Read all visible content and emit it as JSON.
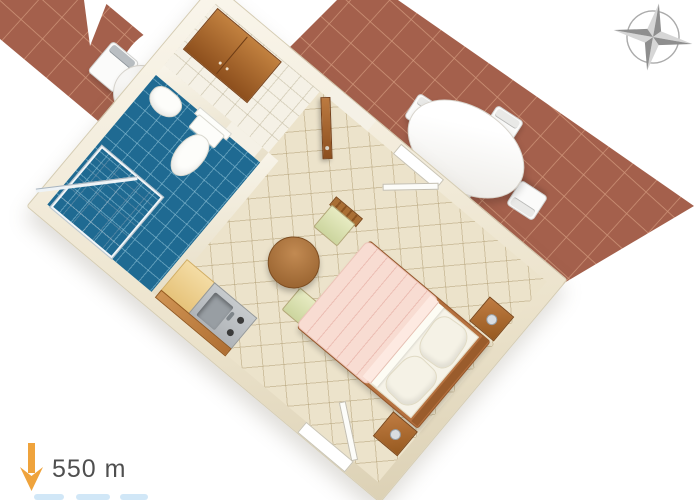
{
  "page": {
    "kind": "3d-floor-plan-render",
    "background": "#ffffff"
  },
  "distance_marker": {
    "label": "550 m",
    "arrow_icon": "down-arrow-icon",
    "arrow_color": "#efa33c",
    "label_color": "#4f4f4f"
  },
  "compass": {
    "icon": "compass-rose-icon",
    "points": 4,
    "color_dark": "#8e8e8e",
    "color_light": "#d6d6d6",
    "ring_color": "#ababab"
  },
  "terraces": {
    "tile_color": "#a4604c",
    "grout_color": "#cf9579",
    "upper_right_terrace": {
      "furniture": [
        "oval-table",
        "terrace-chair",
        "terrace-chair",
        "terrace-chair",
        "terrace-chair"
      ]
    },
    "upper_left_terrace": {
      "furniture": [
        "small-round-table",
        "terrace-chair"
      ]
    }
  },
  "apartment": {
    "wall_color": "#f2ecdd",
    "hallway": {
      "floor_color": "#f5f1e6",
      "furniture": [
        "wardrobe"
      ],
      "openings": [
        "entrance-door"
      ]
    },
    "bathroom": {
      "floor_color": "#1f6a92",
      "fixtures": [
        "shower-cabin",
        "toilet",
        "washbasin"
      ],
      "openings": [
        "bathroom-doorway"
      ]
    },
    "main_room": {
      "floor_color": "#ece3cb",
      "furniture": [
        "kitchenette",
        "sink",
        "hob",
        "dining-table",
        "dining-chair",
        "dining-chair",
        "double-bed",
        "nightstand",
        "nightstand"
      ],
      "openings": [
        "window-top-wall",
        "window-bottom-wall"
      ],
      "bed_colors": {
        "blanket": "#f8dcd2",
        "sheets": "#f6f3e8",
        "frame": "#b5713f"
      }
    }
  }
}
